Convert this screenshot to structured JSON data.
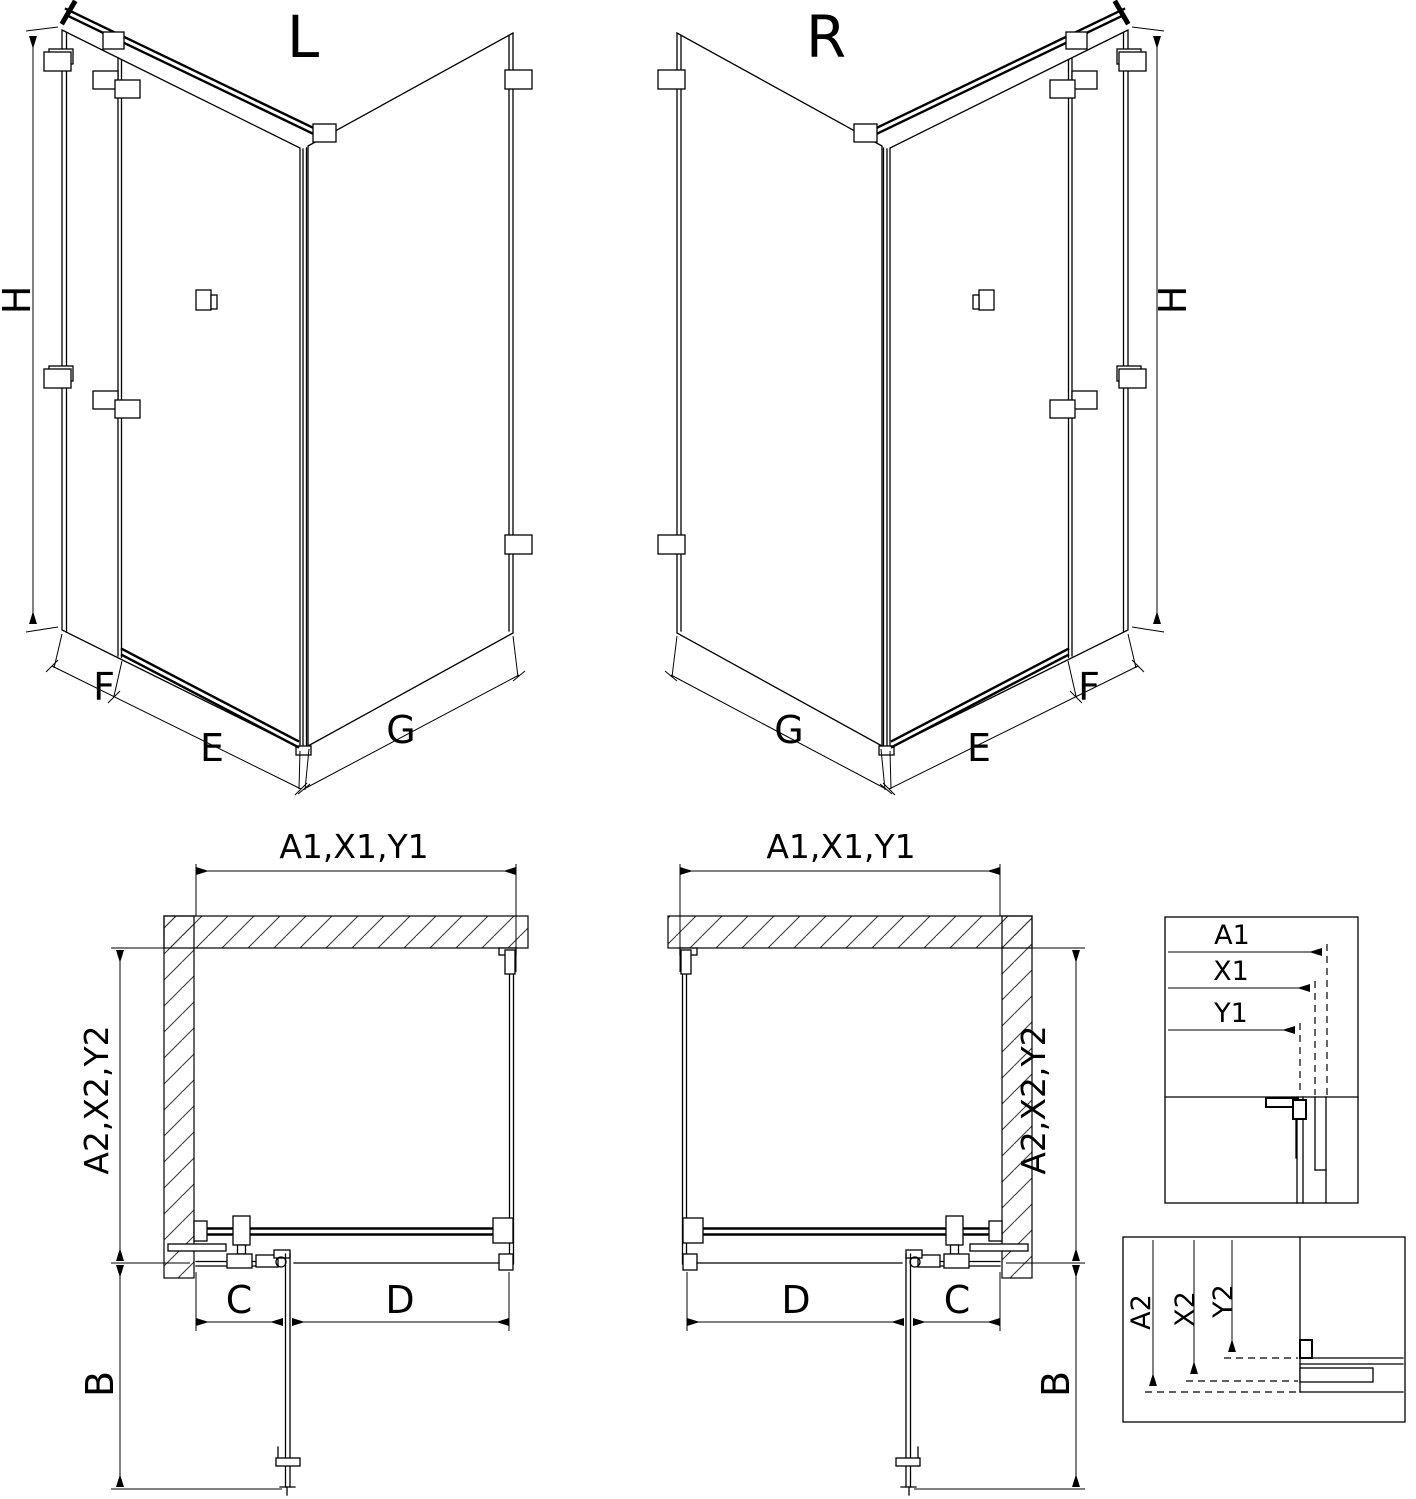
{
  "diagram": {
    "type": "technical-drawing",
    "subject": "corner shower enclosure with hinged door, left (L) and right (R) versions",
    "colors": {
      "line": "#000000",
      "background": "#ffffff"
    },
    "views": {
      "iso_left_title": "L",
      "iso_right_title": "R",
      "height_label": "H",
      "fixed_panel_label": "F",
      "door_label": "E",
      "side_wall_label": "G",
      "plan_width_label": "A1,X1,Y1",
      "plan_depth_label": "A2,X2,Y2",
      "plan_panel_label": "C",
      "plan_door_label": "D",
      "plan_door_open_label": "B"
    },
    "detail_width": {
      "labels": {
        "a1": "A1",
        "x1": "X1",
        "y1": "Y1"
      }
    },
    "detail_depth": {
      "labels": {
        "a2": "A2",
        "x2": "X2",
        "y2": "Y2"
      }
    }
  }
}
